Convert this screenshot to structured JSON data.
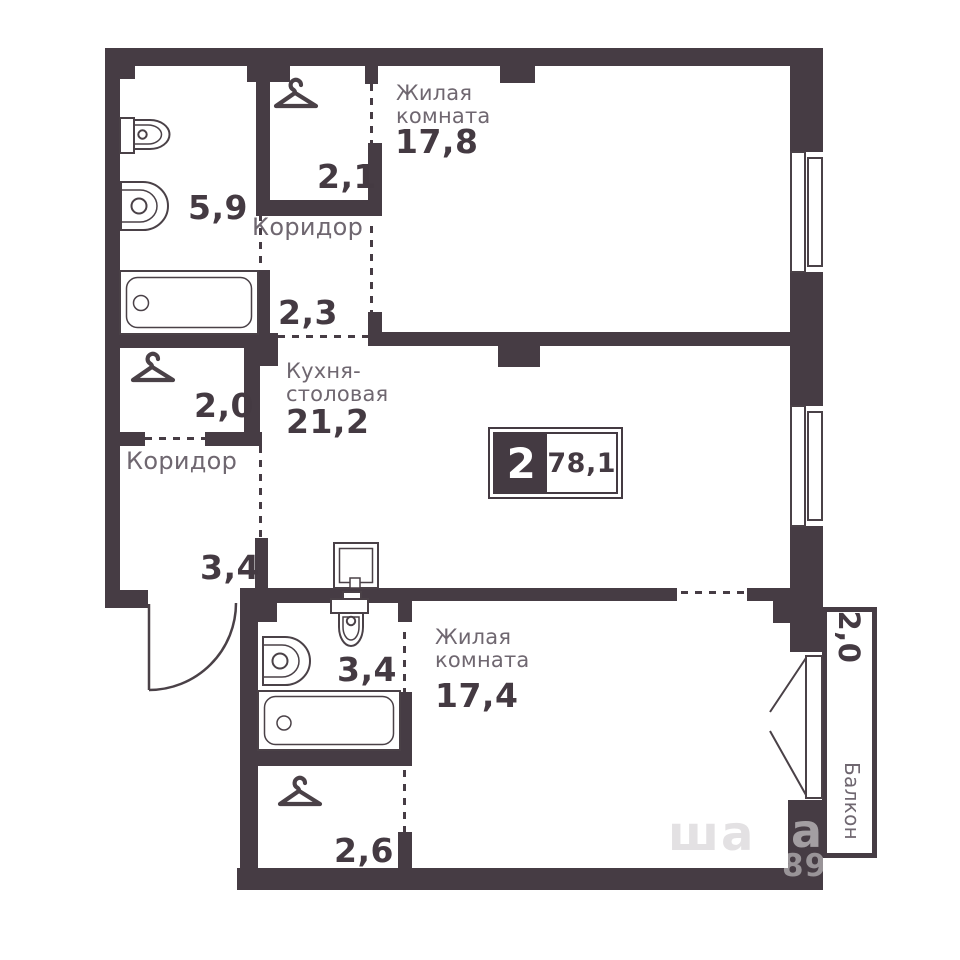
{
  "plan": {
    "badge": {
      "rooms_count": "2",
      "total_area": "78,1"
    },
    "rooms": {
      "living_top": {
        "name_line1": "Жилая",
        "name_line2": "комната",
        "area": "17,8"
      },
      "closet_top": {
        "area": "2,1"
      },
      "hall_top": {
        "name": "Коридор",
        "area": "2,3"
      },
      "kitchen": {
        "name_line1": "Кухня-",
        "name_line2": "столовая",
        "area": "21,2"
      },
      "bath_main": {
        "area": "5,9"
      },
      "closet_left": {
        "area": "2,0"
      },
      "hall_left": {
        "name": "Коридор",
        "area": "3,4"
      },
      "bath_small": {
        "area": "3,4"
      },
      "closet_bottom": {
        "area": "2,6"
      },
      "living_bottom": {
        "name_line1": "Жилая",
        "name_line2": "комната",
        "area": "17,4"
      },
      "balcony": {
        "name": "Балкон",
        "area": "2,0"
      }
    },
    "watermark": {
      "overlay_text": "ша",
      "wall_letter": "а",
      "wall_digits": "89"
    },
    "colors": {
      "wall": "#463c44",
      "room_name": "#6f6770",
      "area_number": "#443a42",
      "background": "#ffffff"
    }
  }
}
